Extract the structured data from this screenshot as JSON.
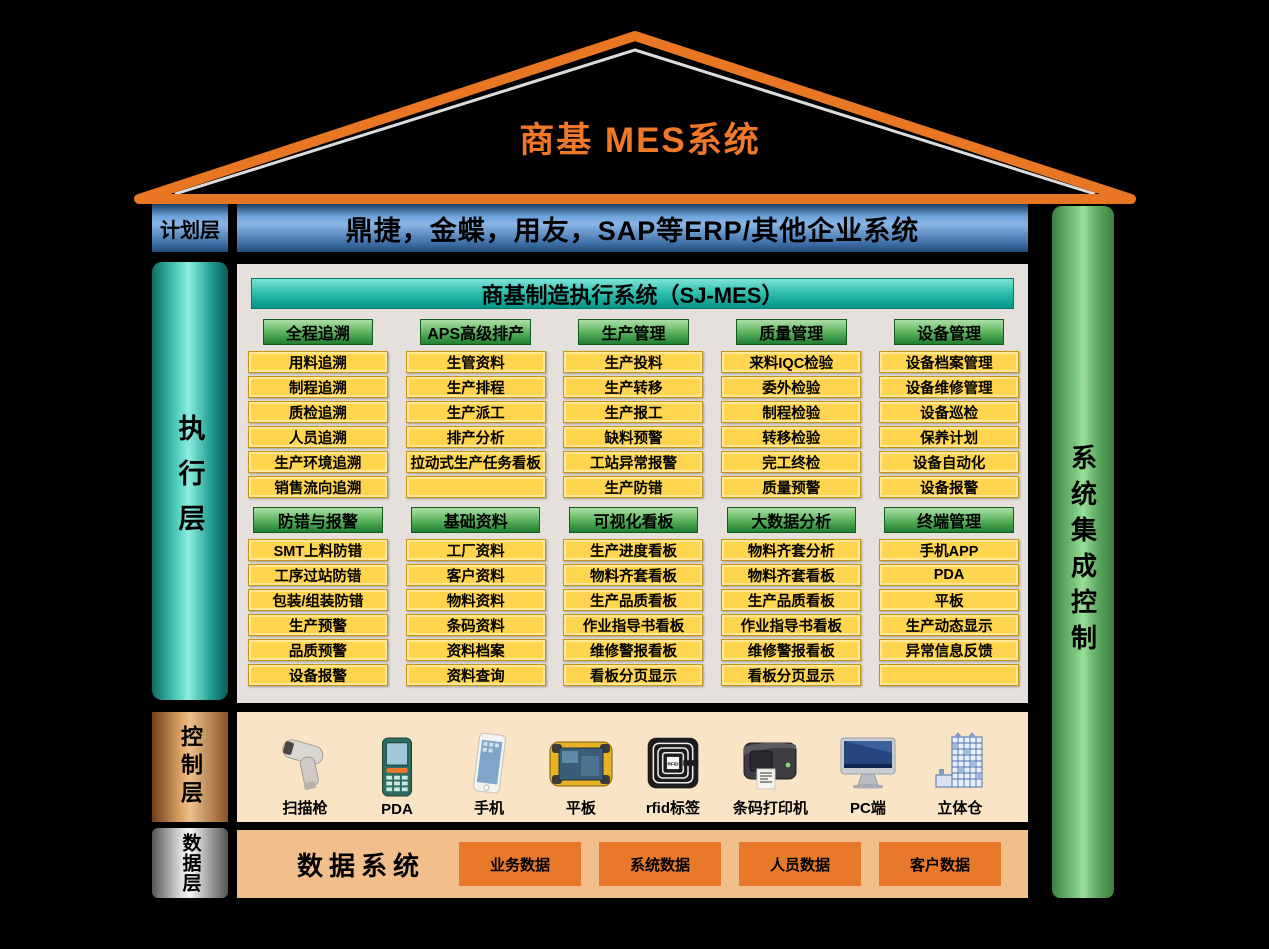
{
  "title": "商基  MES系统",
  "plan_layer": {
    "label": "计划层",
    "erp_text": "鼎捷，金蝶，用友，SAP等ERP/其他企业系统"
  },
  "exec_layer": {
    "label": "执行层"
  },
  "integration_bar": {
    "label": "系统集成控制"
  },
  "sjmes": {
    "header": "商基制造执行系统（SJ-MES）",
    "module_rows": [
      [
        {
          "header": "全程追溯",
          "items": [
            "用料追溯",
            "制程追溯",
            "质检追溯",
            "人员追溯",
            "生产环境追溯",
            "销售流向追溯"
          ]
        },
        {
          "header": "APS高级排产",
          "items": [
            "生管资料",
            "生产排程",
            "生产派工",
            "排产分析",
            "拉动式生产任务看板",
            ""
          ]
        },
        {
          "header": "生产管理",
          "items": [
            "生产投料",
            "生产转移",
            "生产报工",
            "缺料预警",
            "工站异常报警",
            "生产防错"
          ]
        },
        {
          "header": "质量管理",
          "items": [
            "来料IQC检验",
            "委外检验",
            "制程检验",
            "转移检验",
            "完工终检",
            "质量预警"
          ]
        },
        {
          "header": "设备管理",
          "items": [
            "设备档案管理",
            "设备维修管理",
            "设备巡检",
            "保养计划",
            "设备自动化",
            "设备报警"
          ]
        }
      ],
      [
        {
          "header": "防错与报警",
          "items": [
            "SMT上料防错",
            "工序过站防错",
            "包装/组装防错",
            "生产预警",
            "品质预警",
            "设备报警"
          ]
        },
        {
          "header": "基础资料",
          "items": [
            "工厂资料",
            "客户资料",
            "物料资料",
            "条码资料",
            "资料档案",
            "资料查询"
          ]
        },
        {
          "header": "可视化看板",
          "items": [
            "生产进度看板",
            "物料齐套看板",
            "生产品质看板",
            "作业指导书看板",
            "维修警报看板",
            "看板分页显示"
          ]
        },
        {
          "header": "大数据分析",
          "items": [
            "物料齐套分析",
            "物料齐套看板",
            "生产品质看板",
            "作业指导书看板",
            "维修警报看板",
            "看板分页显示"
          ]
        },
        {
          "header": "终端管理",
          "items": [
            "手机APP",
            "PDA",
            "平板",
            "生产动态显示",
            "异常信息反馈",
            ""
          ]
        }
      ]
    ]
  },
  "control_layer": {
    "label": "控制层",
    "devices": [
      {
        "icon": "barcode-scanner-icon",
        "label": "扫描枪"
      },
      {
        "icon": "pda-icon",
        "label": "PDA"
      },
      {
        "icon": "phone-icon",
        "label": "手机"
      },
      {
        "icon": "tablet-icon",
        "label": "平板"
      },
      {
        "icon": "rfid-tag-icon",
        "label": "rfid标签"
      },
      {
        "icon": "barcode-printer-icon",
        "label": "条码打印机"
      },
      {
        "icon": "pc-monitor-icon",
        "label": "PC端"
      },
      {
        "icon": "warehouse-icon",
        "label": "立体仓"
      }
    ]
  },
  "data_layer": {
    "label": "数据层",
    "system_label": "数据系统",
    "chips": [
      "业务数据",
      "系统数据",
      "人员数据",
      "客户数据"
    ]
  },
  "colors": {
    "background": "#000000",
    "roof_orange": "#E87622",
    "title_orange": "#F07828",
    "erp_blue": "#5B8FD0",
    "exec_teal": "#2FB8A8",
    "integration_green": "#7CC87E",
    "module_header_green": "#3F9A4C",
    "module_item_yellow": "#FFD44E",
    "control_copper": "#C98A52",
    "control_bg": "#FAE4C6",
    "data_bg": "#F2BF8C",
    "data_chip_orange": "#E8792A",
    "panel_bg": "#E6E0DC"
  }
}
